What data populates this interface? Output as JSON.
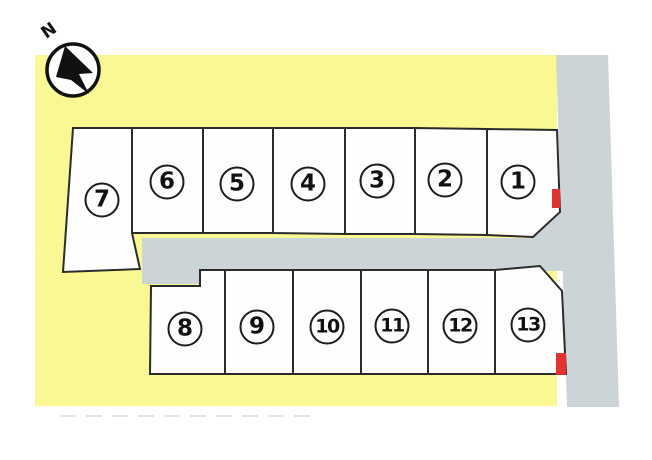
{
  "map": {
    "compass": {
      "label": "N"
    },
    "plots": [
      {
        "number": "1"
      },
      {
        "number": "2"
      },
      {
        "number": "3"
      },
      {
        "number": "4"
      },
      {
        "number": "5"
      },
      {
        "number": "6"
      },
      {
        "number": "7"
      },
      {
        "number": "8"
      },
      {
        "number": "9"
      },
      {
        "number": "10"
      },
      {
        "number": "11"
      },
      {
        "number": "12"
      },
      {
        "number": "13"
      }
    ],
    "markers": [
      {
        "name": "red-marker-plot-1",
        "plot": "1"
      },
      {
        "name": "red-marker-plot-13",
        "plot": "13"
      }
    ],
    "colors": {
      "background": "#ffffff",
      "land": "#faf892",
      "road": "#cbd4d7",
      "plot_fill": "#fefefe",
      "outline": "#2b2b2b",
      "marker": "#e5312d"
    }
  }
}
